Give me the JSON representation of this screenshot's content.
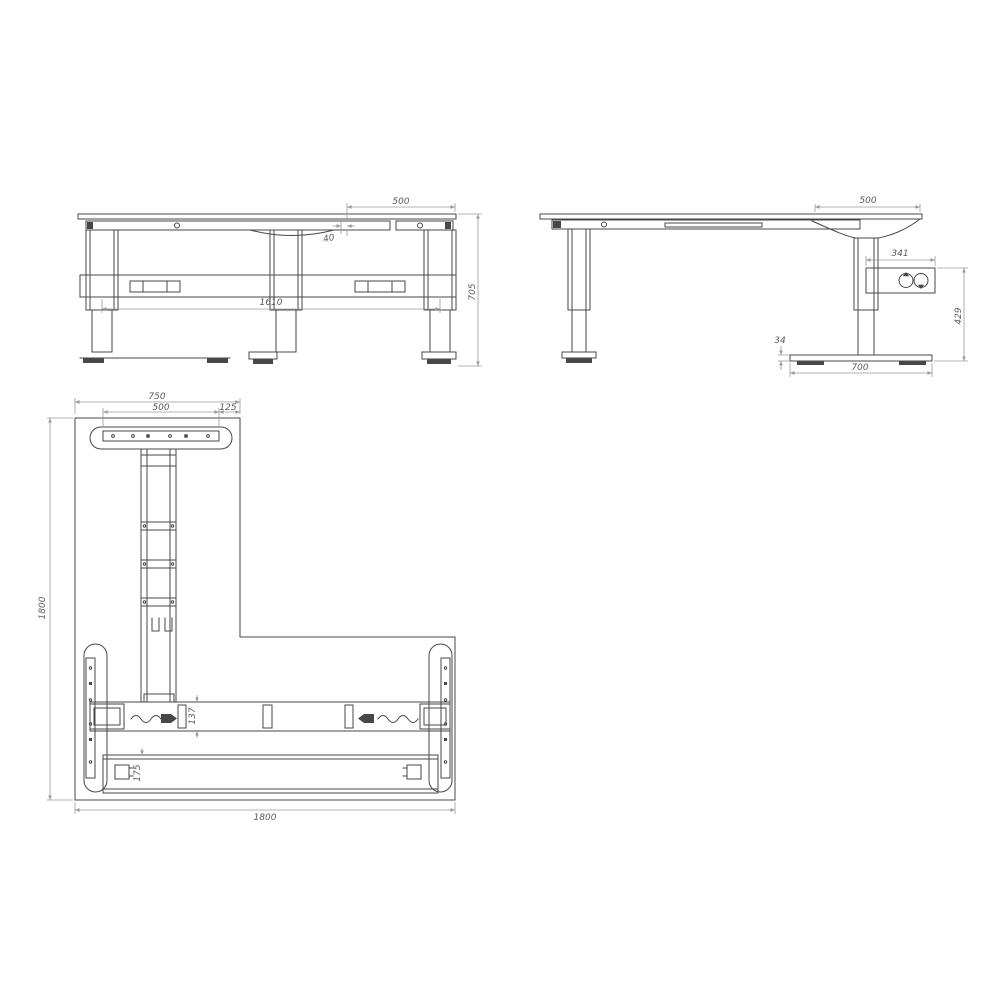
{
  "meta": {
    "background": "#ffffff",
    "structure_line_color": "#474747",
    "dimension_line_color": "#9a9a9a",
    "dimension_text_color": "#5a5a5a"
  },
  "front_view": {
    "name": "front elevation of L-desk",
    "dim_top_right_overhang": "500",
    "dim_rail_setback": "40",
    "dim_leg_spacing": "1610",
    "dim_overall_height": "705"
  },
  "side_view": {
    "name": "side elevation of L-desk",
    "dim_top_overhang": "500",
    "dim_control_box_length": "341",
    "dim_control_box_floor_height": "429",
    "dim_foot_thickness": "34",
    "dim_foot_length": "700"
  },
  "plan_view": {
    "name": "plan view of L-desk",
    "dim_return_arm_width": "750",
    "dim_foot_plate_width": "500",
    "dim_edge_offset": "125",
    "dim_overall_depth": "1800",
    "dim_overall_width": "1800",
    "dim_crossbar_width": "137",
    "dim_rear_beam_width": "175"
  }
}
